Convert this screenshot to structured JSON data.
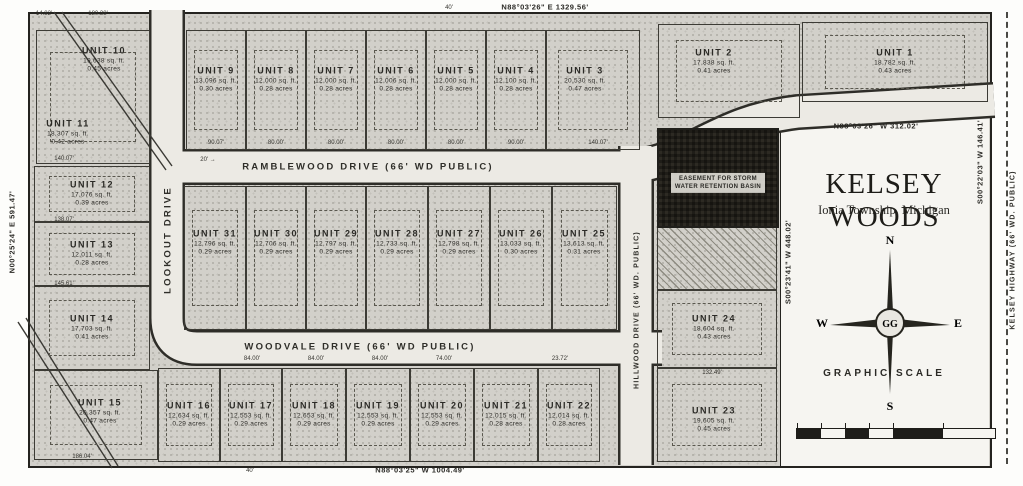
{
  "title": {
    "main": "KELSEY WOODS",
    "sub": "Ionia Township, Michigan"
  },
  "compass": {
    "n": "N",
    "e": "E",
    "s": "S",
    "w": "W",
    "hub": "GG"
  },
  "scale": {
    "label": "GRAPHIC SCALE",
    "segments": [
      {
        "w": 24,
        "dark": true
      },
      {
        "w": 24,
        "dark": false
      },
      {
        "w": 24,
        "dark": true
      },
      {
        "w": 24,
        "dark": false
      },
      {
        "w": 50,
        "dark": true
      },
      {
        "w": 50,
        "dark": false
      }
    ]
  },
  "streets": {
    "ramblewood": {
      "label": "RAMBLEWOOD DRIVE (66' WD PUBLIC)"
    },
    "lookout": {
      "label": "LOOKOUT DRIVE"
    },
    "woodvale": {
      "label": "WOODVALE DRIVE (66' WD PUBLIC)"
    },
    "hillwood": {
      "label": "HILLWOOD DRIVE (66' WD. PUBLIC)"
    },
    "kelsey": {
      "label": "KELSEY HIGHWAY (66' WD. PUBLIC)"
    }
  },
  "easement": {
    "label": "EASEMENT FOR STORM WATER RETENTION BASIN"
  },
  "units": [
    {
      "name": "UNIT 1",
      "sqft": "18,782 sq. ft.",
      "acres": "0.43 acres",
      "rect": [
        802,
        22,
        186,
        80
      ]
    },
    {
      "name": "UNIT 2",
      "sqft": "17,838 sq. ft.",
      "acres": "0.41 acres",
      "rect": [
        658,
        24,
        142,
        94
      ],
      "label_at": [
        714,
        62
      ]
    },
    {
      "name": "UNIT 3",
      "sqft": "20,530 sq. ft.",
      "acres": "0.47 acres",
      "rect": [
        546,
        30,
        94,
        120
      ],
      "label_at": [
        585,
        80
      ]
    },
    {
      "name": "UNIT 4",
      "sqft": "12,100 sq. ft.",
      "acres": "0.28 acres",
      "rect": [
        486,
        30,
        60,
        120
      ],
      "label_at": [
        516,
        80
      ]
    },
    {
      "name": "UNIT 5",
      "sqft": "12,000 sq. ft.",
      "acres": "0.28 acres",
      "rect": [
        426,
        30,
        60,
        120
      ],
      "label_at": [
        456,
        80
      ]
    },
    {
      "name": "UNIT 6",
      "sqft": "12,006 sq. ft.",
      "acres": "0.28 acres",
      "rect": [
        366,
        30,
        60,
        120
      ],
      "label_at": [
        396,
        80
      ]
    },
    {
      "name": "UNIT 7",
      "sqft": "12,000 sq. ft.",
      "acres": "0.28 acres",
      "rect": [
        306,
        30,
        60,
        120
      ],
      "label_at": [
        336,
        80
      ]
    },
    {
      "name": "UNIT 8",
      "sqft": "12,000 sq. ft.",
      "acres": "0.28 acres",
      "rect": [
        246,
        30,
        60,
        120
      ],
      "label_at": [
        276,
        80
      ]
    },
    {
      "name": "UNIT 9",
      "sqft": "13,096 sq. ft.",
      "acres": "0.30 acres",
      "rect": [
        186,
        30,
        60,
        120
      ],
      "label_at": [
        216,
        80
      ]
    },
    {
      "name": "UNIT 10",
      "sqft": "19,638 sq. ft.",
      "acres": "0.45 acres",
      "rect": [
        36,
        30,
        114,
        134
      ],
      "label_at": [
        104,
        60
      ]
    },
    {
      "name": "UNIT 11",
      "sqft": "18,307 sq. ft.",
      "acres": "0.42 acres",
      "no_border": true,
      "label_at": [
        68,
        133
      ]
    },
    {
      "name": "UNIT 12",
      "sqft": "17,076 sq. ft.",
      "acres": "0.39 acres",
      "rect": [
        34,
        166,
        116,
        56
      ]
    },
    {
      "name": "UNIT 13",
      "sqft": "12,011 sq. ft.",
      "acres": "0.28 acres",
      "rect": [
        34,
        222,
        116,
        64
      ]
    },
    {
      "name": "UNIT 14",
      "sqft": "17,703 sq. ft.",
      "acres": "0.41 acres",
      "rect": [
        34,
        286,
        116,
        84
      ]
    },
    {
      "name": "UNIT 15",
      "sqft": "20,357 sq. ft.",
      "acres": "0.47 acres",
      "rect": [
        34,
        370,
        124,
        90
      ],
      "label_at": [
        100,
        412
      ]
    },
    {
      "name": "UNIT 16",
      "sqft": "12,634 sq. ft.",
      "acres": "0.29 acres",
      "rect": [
        158,
        368,
        62,
        94
      ]
    },
    {
      "name": "UNIT 17",
      "sqft": "12,553 sq. ft.",
      "acres": "0.29 acres",
      "rect": [
        220,
        368,
        62,
        94
      ]
    },
    {
      "name": "UNIT 18",
      "sqft": "12,653 sq. ft.",
      "acres": "0.29 acres",
      "rect": [
        282,
        368,
        64,
        94
      ]
    },
    {
      "name": "UNIT 19",
      "sqft": "12,553 sq. ft.",
      "acres": "0.29 acres",
      "rect": [
        346,
        368,
        64,
        94
      ]
    },
    {
      "name": "UNIT 20",
      "sqft": "12,553 sq. ft.",
      "acres": "0.29 acres",
      "rect": [
        410,
        368,
        64,
        94
      ]
    },
    {
      "name": "UNIT 21",
      "sqft": "12,015 sq. ft.",
      "acres": "0.28 acres",
      "rect": [
        474,
        368,
        64,
        94
      ]
    },
    {
      "name": "UNIT 22",
      "sqft": "12,014 sq. ft.",
      "acres": "0.28 acres",
      "rect": [
        538,
        368,
        62,
        94
      ]
    },
    {
      "name": "UNIT 23",
      "sqft": "19,605 sq. ft.",
      "acres": "0.45 acres",
      "rect": [
        657,
        368,
        120,
        94
      ],
      "label_at": [
        714,
        420
      ]
    },
    {
      "name": "UNIT 24",
      "sqft": "18,604 sq. ft.",
      "acres": "0.43 acres",
      "rect": [
        657,
        290,
        120,
        78
      ],
      "label_at": [
        714,
        328
      ]
    },
    {
      "name": "UNIT 25",
      "sqft": "13,613 sq. ft.",
      "acres": "0.31 acres",
      "rect": [
        552,
        186,
        65,
        144
      ],
      "label_at": [
        584,
        243
      ]
    },
    {
      "name": "UNIT 26",
      "sqft": "13,033 sq. ft.",
      "acres": "0.30 acres",
      "rect": [
        490,
        186,
        62,
        144
      ],
      "label_at": [
        521,
        243
      ]
    },
    {
      "name": "UNIT 27",
      "sqft": "12,798 sq. ft.",
      "acres": "0.29 acres",
      "rect": [
        428,
        186,
        62,
        144
      ],
      "label_at": [
        459,
        243
      ]
    },
    {
      "name": "UNIT 28",
      "sqft": "12,733 sq. ft.",
      "acres": "0.29 acres",
      "rect": [
        366,
        186,
        62,
        144
      ],
      "label_at": [
        397,
        243
      ]
    },
    {
      "name": "UNIT 29",
      "sqft": "12,797 sq. ft.",
      "acres": "0.29 acres",
      "rect": [
        306,
        186,
        60,
        144
      ],
      "label_at": [
        336,
        243
      ]
    },
    {
      "name": "UNIT 30",
      "sqft": "12,706 sq. ft.",
      "acres": "0.29 acres",
      "rect": [
        246,
        186,
        60,
        144
      ],
      "label_at": [
        276,
        243
      ]
    },
    {
      "name": "UNIT 31",
      "sqft": "12,796 sq. ft.",
      "acres": "0.29 acres",
      "rect": [
        184,
        186,
        62,
        144
      ],
      "label_at": [
        215,
        243
      ]
    }
  ],
  "bearings": [
    {
      "t": "N88°03'26\" E  1329.56'",
      "x": 545,
      "y": 7,
      "vert": false
    },
    {
      "t": "N88°03'25\" W  1004.49'",
      "x": 420,
      "y": 470,
      "vert": false
    },
    {
      "t": "N88°03'26\" W  312.02'",
      "x": 876,
      "y": 126,
      "vert": false
    },
    {
      "t": "N00°25'24\" E  591.47'",
      "x": 12,
      "y": 232,
      "vert": true
    },
    {
      "t": "S00°23'41\" W  448.02'",
      "x": 788,
      "y": 262,
      "vert": true
    },
    {
      "t": "S00°22'03\" W  146.41'",
      "x": 980,
      "y": 162,
      "vert": true
    }
  ],
  "dimensions": [
    {
      "t": "14.82'",
      "x": 44,
      "y": 14
    },
    {
      "t": "180.38'",
      "x": 98,
      "y": 14
    },
    {
      "t": "40'",
      "x": 449,
      "y": 8
    },
    {
      "t": "40'",
      "x": 250,
      "y": 471
    },
    {
      "t": "20' →",
      "x": 208,
      "y": 160
    },
    {
      "t": "90.07'",
      "x": 216,
      "y": 143
    },
    {
      "t": "80.00'",
      "x": 276,
      "y": 143
    },
    {
      "t": "80.00'",
      "x": 336,
      "y": 143
    },
    {
      "t": "80.00'",
      "x": 396,
      "y": 143
    },
    {
      "t": "80.00'",
      "x": 456,
      "y": 143
    },
    {
      "t": "90.00'",
      "x": 516,
      "y": 143
    },
    {
      "t": "140.07'",
      "x": 598,
      "y": 143
    },
    {
      "t": "140.07'",
      "x": 64,
      "y": 159
    },
    {
      "t": "138.07'",
      "x": 64,
      "y": 220
    },
    {
      "t": "145.61'",
      "x": 64,
      "y": 284
    },
    {
      "t": "186.04'",
      "x": 82,
      "y": 457
    },
    {
      "t": "84.00'",
      "x": 252,
      "y": 359
    },
    {
      "t": "84.00'",
      "x": 316,
      "y": 359
    },
    {
      "t": "84.00'",
      "x": 380,
      "y": 359
    },
    {
      "t": "74.00'",
      "x": 444,
      "y": 359
    },
    {
      "t": "23.72'",
      "x": 560,
      "y": 359
    },
    {
      "t": "132.49'",
      "x": 712,
      "y": 373
    }
  ]
}
